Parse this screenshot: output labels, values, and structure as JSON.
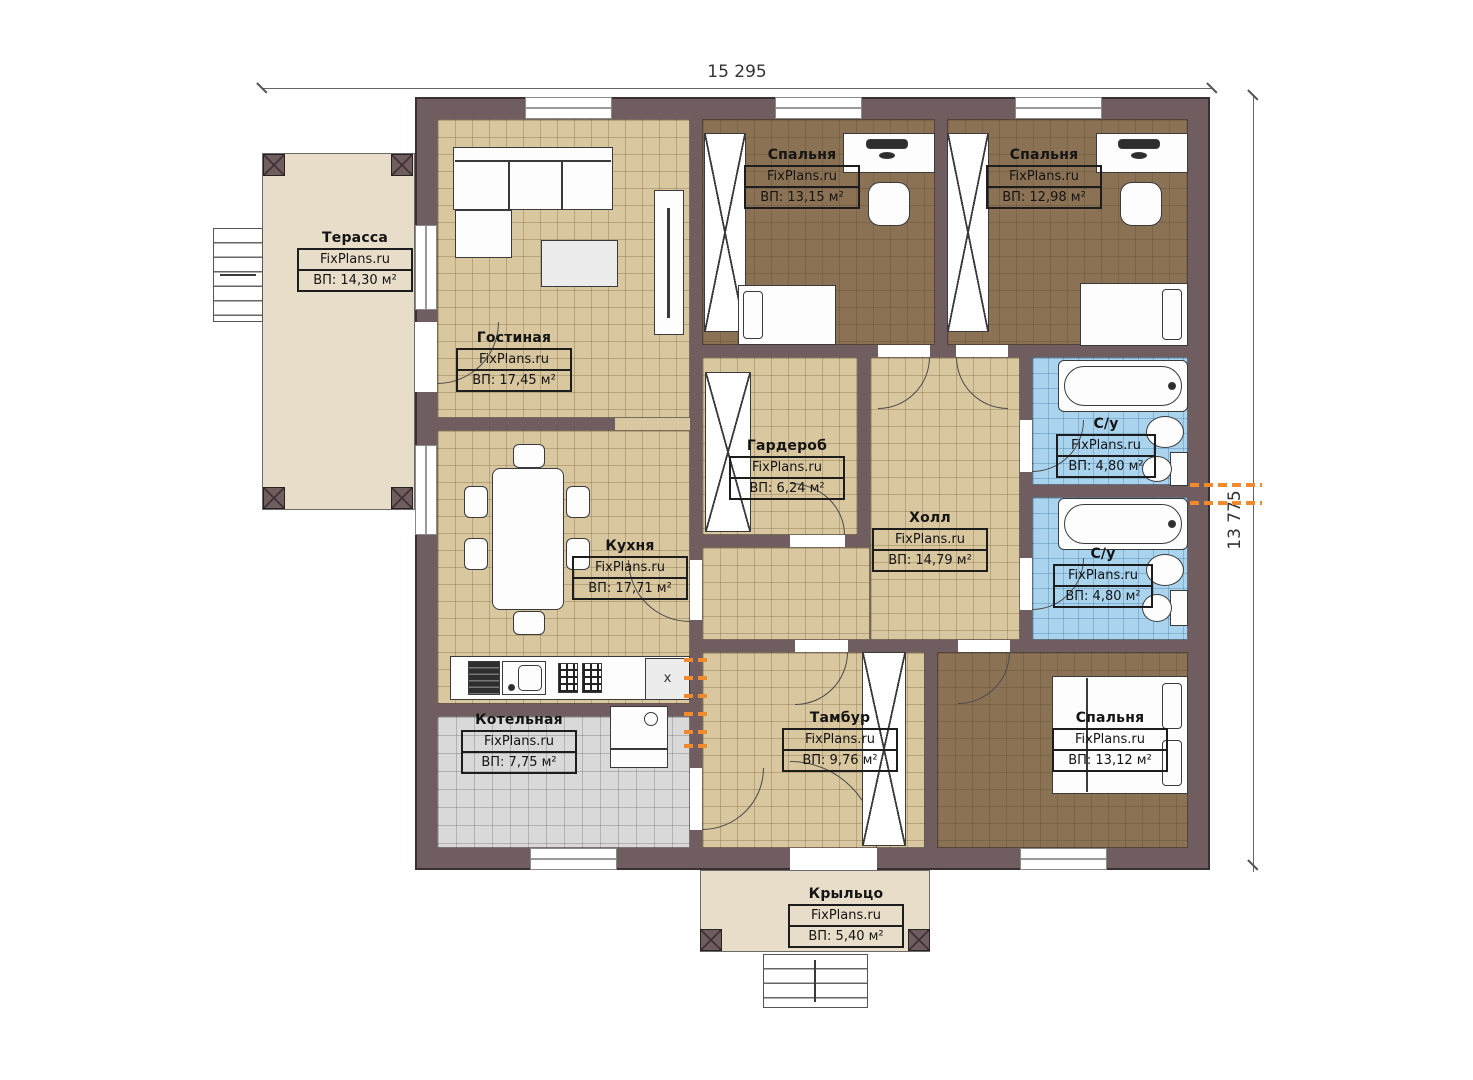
{
  "watermark": "FixPlans.ru",
  "dimensions": {
    "top": "15 295",
    "right": "13 775"
  },
  "rooms": [
    {
      "name": "Терасса",
      "area": "ВП: 14,30 м²"
    },
    {
      "name": "Гостиная",
      "area": "ВП: 17,45 м²"
    },
    {
      "name": "Спальня",
      "area": "ВП: 13,15 м²"
    },
    {
      "name": "Спальня",
      "area": "ВП: 12,98 м²"
    },
    {
      "name": "Гардероб",
      "area": "ВП: 6,24 м²"
    },
    {
      "name": "Холл",
      "area": "ВП: 14,79 м²"
    },
    {
      "name": "С/у",
      "area": "ВП: 4,80 м²"
    },
    {
      "name": "С/у",
      "area": "ВП: 4,80 м²"
    },
    {
      "name": "Кухня",
      "area": "ВП: 17,71 м²"
    },
    {
      "name": "Котельная",
      "area": "ВП: 7,75 м²"
    },
    {
      "name": "Тамбур",
      "area": "ВП: 9,76 м²"
    },
    {
      "name": "Спальня",
      "area": "ВП: 13,12 м²"
    },
    {
      "name": "Крыльцо",
      "area": "ВП: 5,40 м²"
    }
  ],
  "annotations": {
    "kitchen_cabinet_mark": "x"
  },
  "colors": {
    "wall": "#6f5d5f",
    "floor_tile_beige": "#d9c79f",
    "floor_bedroom_brown": "#8b7254",
    "floor_bath_blue": "#aad4ee",
    "floor_boiler_gray": "#d9d9d9",
    "outdoor_beige": "#e8ddc8",
    "radiator_orange": "#f08a2d"
  }
}
